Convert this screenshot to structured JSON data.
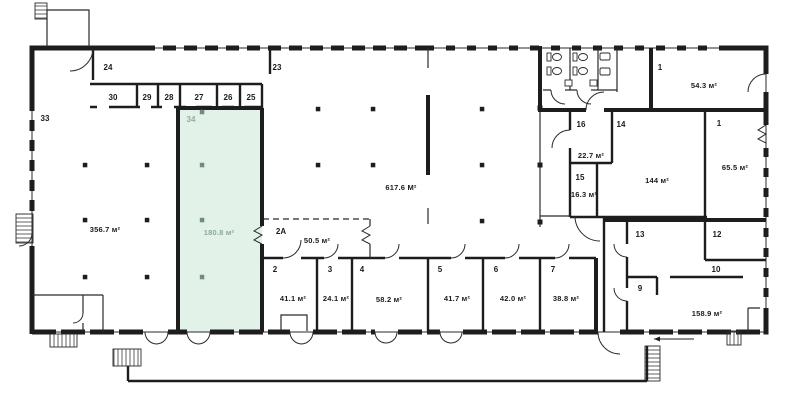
{
  "plan": {
    "colors": {
      "wall": "#1d1d1d",
      "highlight_fill": "#e2f2e9",
      "highlight_label": "#93ad9e"
    },
    "rooms": {
      "r23": {
        "number": "23"
      },
      "r24": {
        "number": "24"
      },
      "r25": {
        "number": "25"
      },
      "r26": {
        "number": "26"
      },
      "r27": {
        "number": "27"
      },
      "r28": {
        "number": "28"
      },
      "r29": {
        "number": "29"
      },
      "r30": {
        "number": "30"
      },
      "r33": {
        "number": "33"
      },
      "r34": {
        "number": "34",
        "area": "180.8 м²"
      },
      "hall_left": {
        "area": "356.7 м²"
      },
      "hall_center": {
        "area": "617.6 М²"
      },
      "r1_top": {
        "number": "1",
        "area": "54.3 м²"
      },
      "r1_right": {
        "number": "1",
        "area": "65.5 м²"
      },
      "r16": {
        "number": "16",
        "area": "22.7 м²"
      },
      "r14": {
        "number": "14"
      },
      "r15": {
        "number": "15",
        "area": "16.3 м²"
      },
      "r144": {
        "area": "144 м²"
      },
      "r2a": {
        "number": "2A",
        "area": "50.5 м²"
      },
      "r2": {
        "number": "2",
        "area": "41.1 м²"
      },
      "r3": {
        "number": "3",
        "area": "24.1 м²"
      },
      "r4": {
        "number": "4",
        "area": "58.2 м²"
      },
      "r5": {
        "number": "5",
        "area": "41.7 м²"
      },
      "r6": {
        "number": "6",
        "area": "42.0 м²"
      },
      "r7": {
        "number": "7",
        "area": "38.8 м²"
      },
      "r9": {
        "number": "9"
      },
      "r10": {
        "number": "10"
      },
      "r12": {
        "number": "12"
      },
      "r13": {
        "number": "13"
      },
      "r158": {
        "area": "158.9 м²"
      }
    }
  }
}
